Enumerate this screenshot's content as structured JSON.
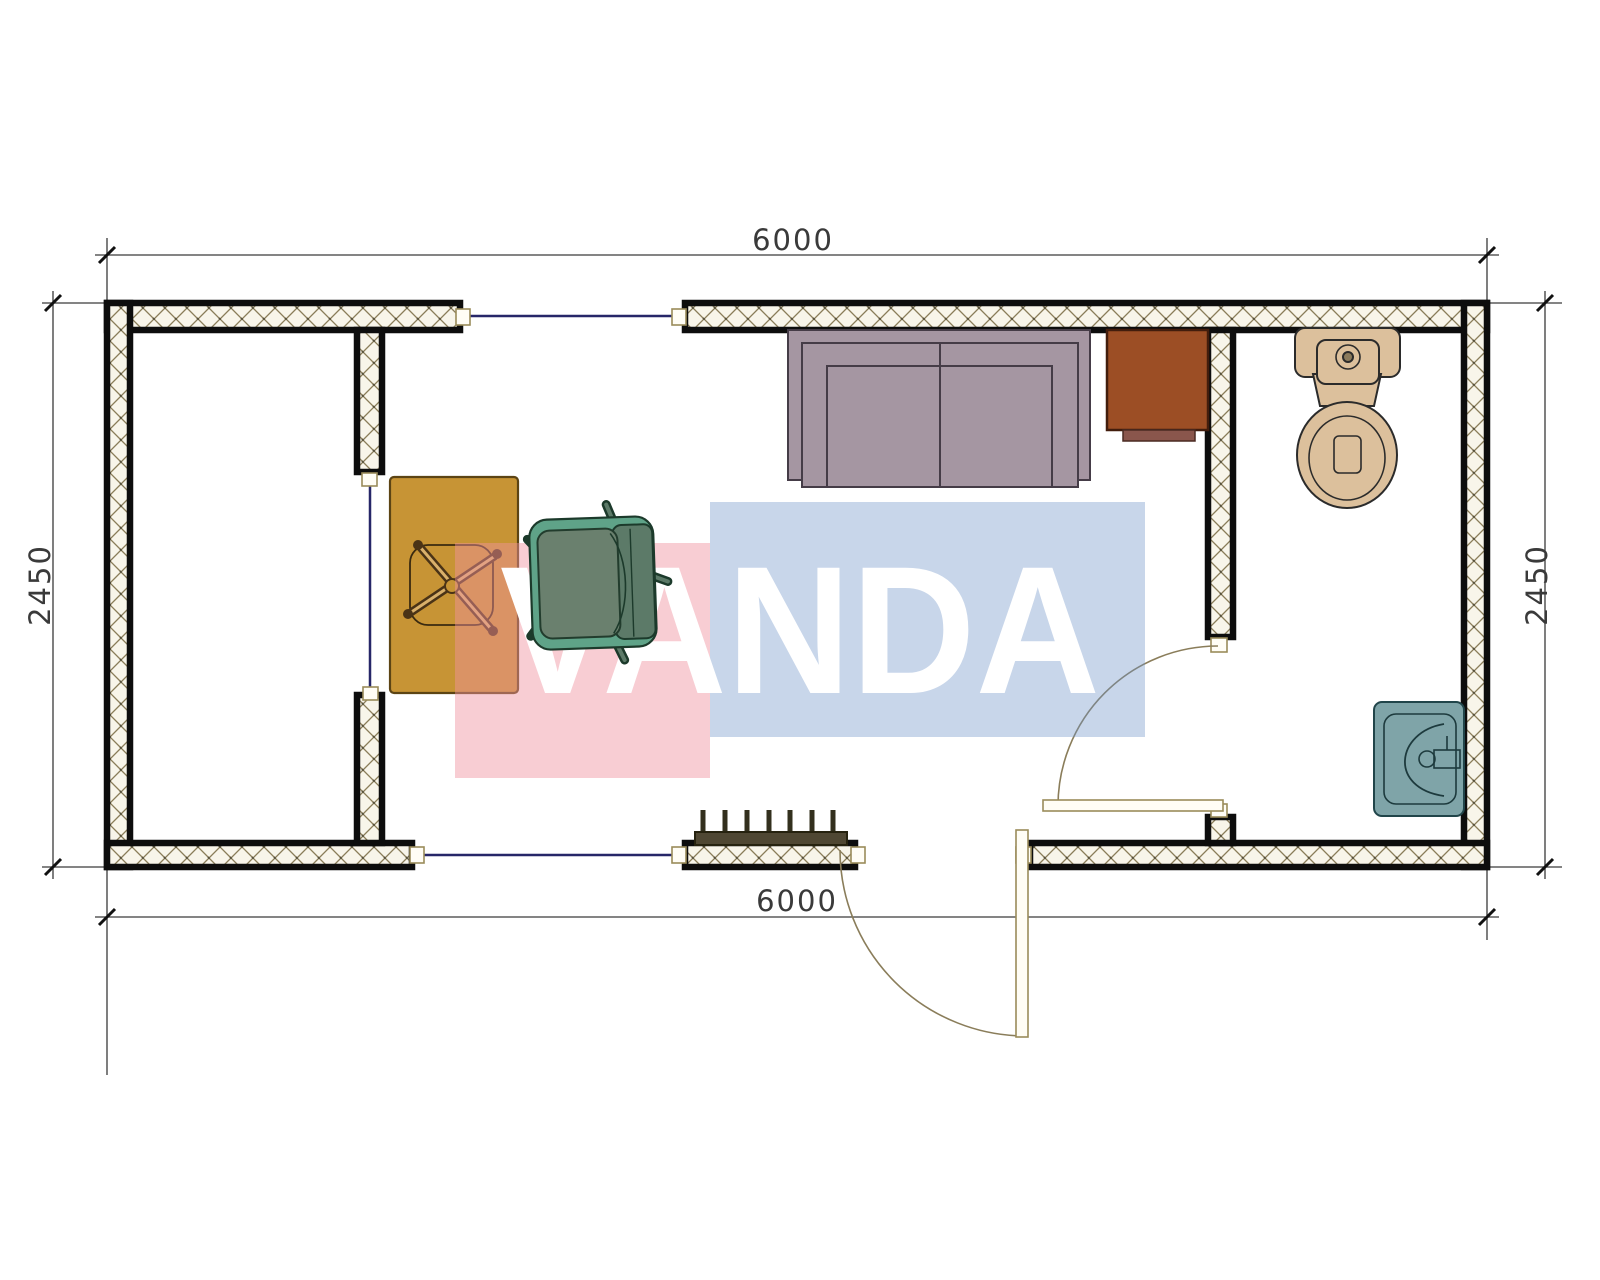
{
  "watermark": {
    "text": "VANDA",
    "pink_color": "#f0919f",
    "blue_color": "#6f94c9"
  },
  "dimensions": {
    "top": "6000",
    "bottom": "6000",
    "left": "2450",
    "right": "2450"
  },
  "walls": {
    "fill": "#f8f5ea",
    "hatch_color": "#8a7d5a",
    "outline_color": "#0d0d0d"
  },
  "openings": {
    "window_color": "#262668",
    "door_color": "#8a7d5a",
    "cap_fill": "#fffdf5",
    "cap_stroke": "#9a8c5a"
  },
  "objects": {
    "sofa": {
      "color": "#a596a2"
    },
    "desk": {
      "color": "#c79435"
    },
    "office_chair": {
      "color": "#6a806e",
      "accent": "#5fa388",
      "back": "#5c7a68"
    },
    "cabinet": {
      "color": "#9c4e25",
      "lip": "#8a564c"
    },
    "toilet": {
      "color": "#dcc09c"
    },
    "sink": {
      "color": "#7fa4a8"
    },
    "radiator": {
      "color": "#4f4733"
    }
  }
}
